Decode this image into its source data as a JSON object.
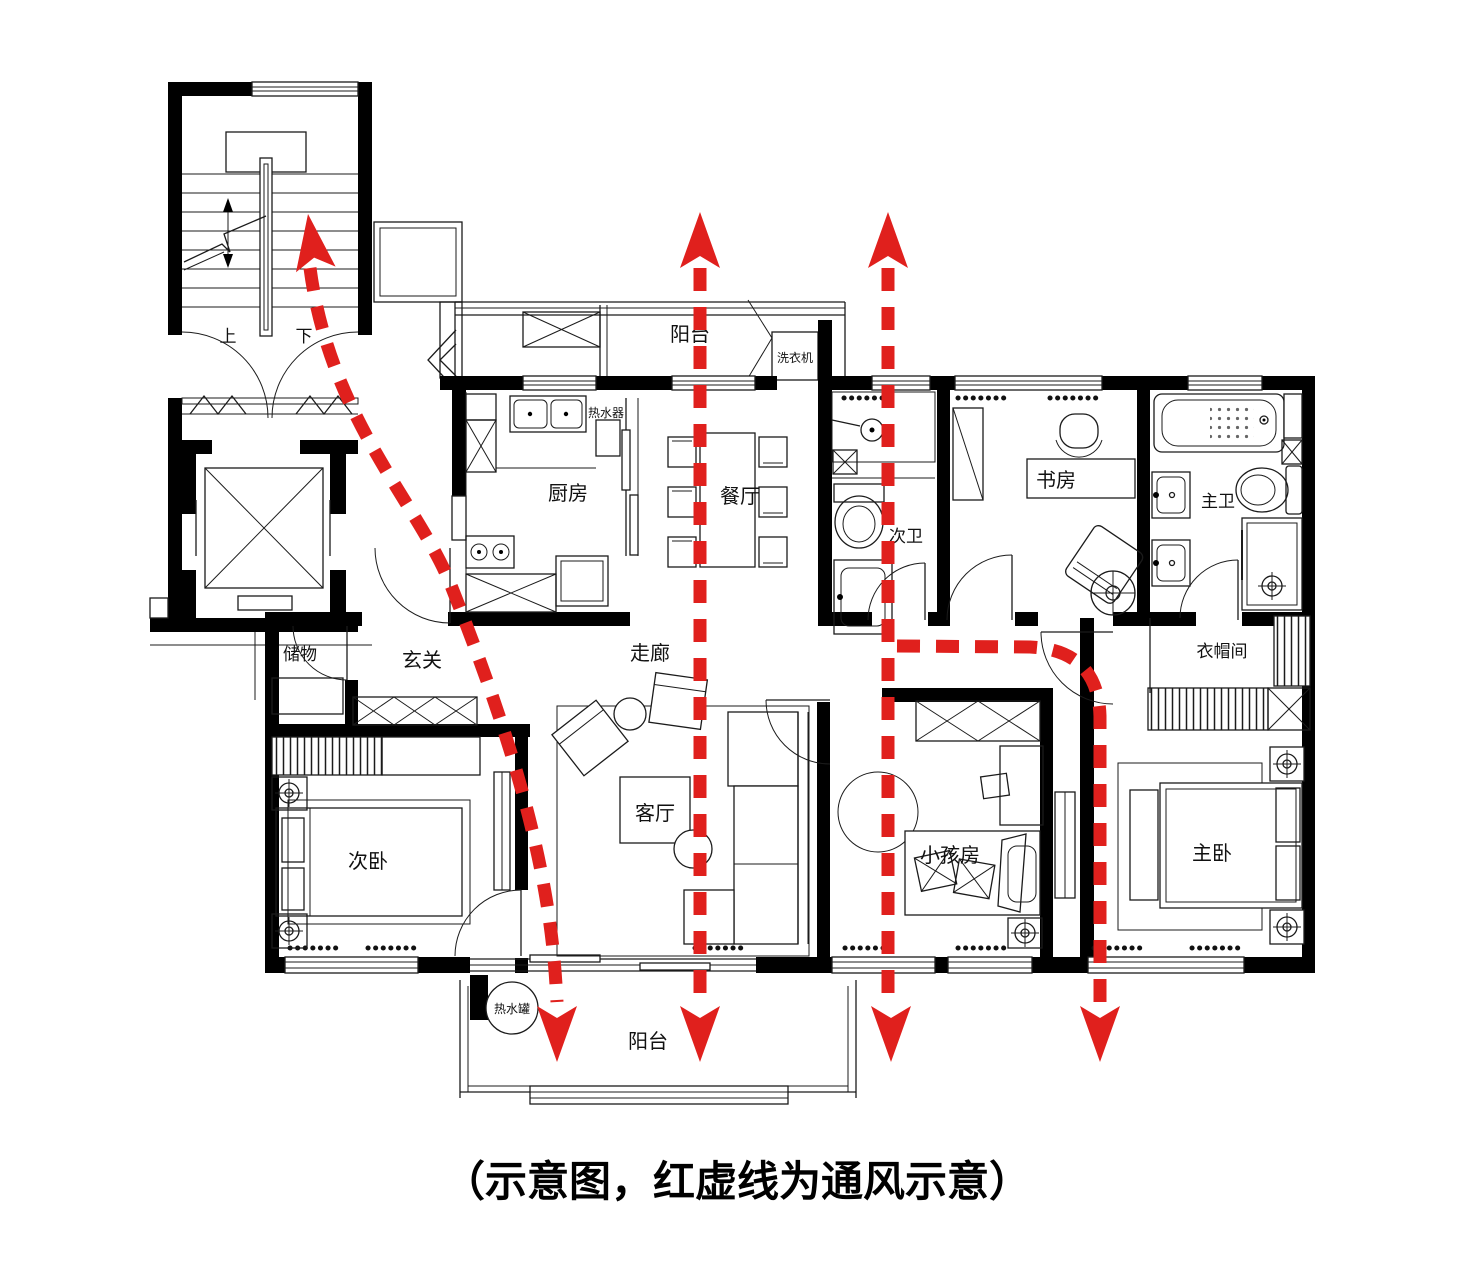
{
  "caption": "（示意图，红虚线为通风示意）",
  "legend": {
    "red_dashed_meaning": "通风示意"
  },
  "colors": {
    "vent_line": "#e0201d",
    "wall": "#000000",
    "ink": "#1b1b1b",
    "background": "#ffffff"
  },
  "rooms": {
    "balcony_top": "阳台",
    "washing_machine": "洗衣机",
    "water_heater": "热水器",
    "kitchen": "厨房",
    "dining": "餐厅",
    "second_bath": "次卫",
    "study": "书房",
    "master_bath": "主卫",
    "storage": "储物",
    "entry": "玄关",
    "corridor": "走廊",
    "cloakroom": "衣帽间",
    "second_bedroom": "次卧",
    "living_room": "客厅",
    "kids_room": "小孩房",
    "master_bedroom": "主卧",
    "balcony_bottom": "阳台",
    "hot_water_tank": "热水罐",
    "stair_up": "上",
    "stair_down": "下"
  }
}
